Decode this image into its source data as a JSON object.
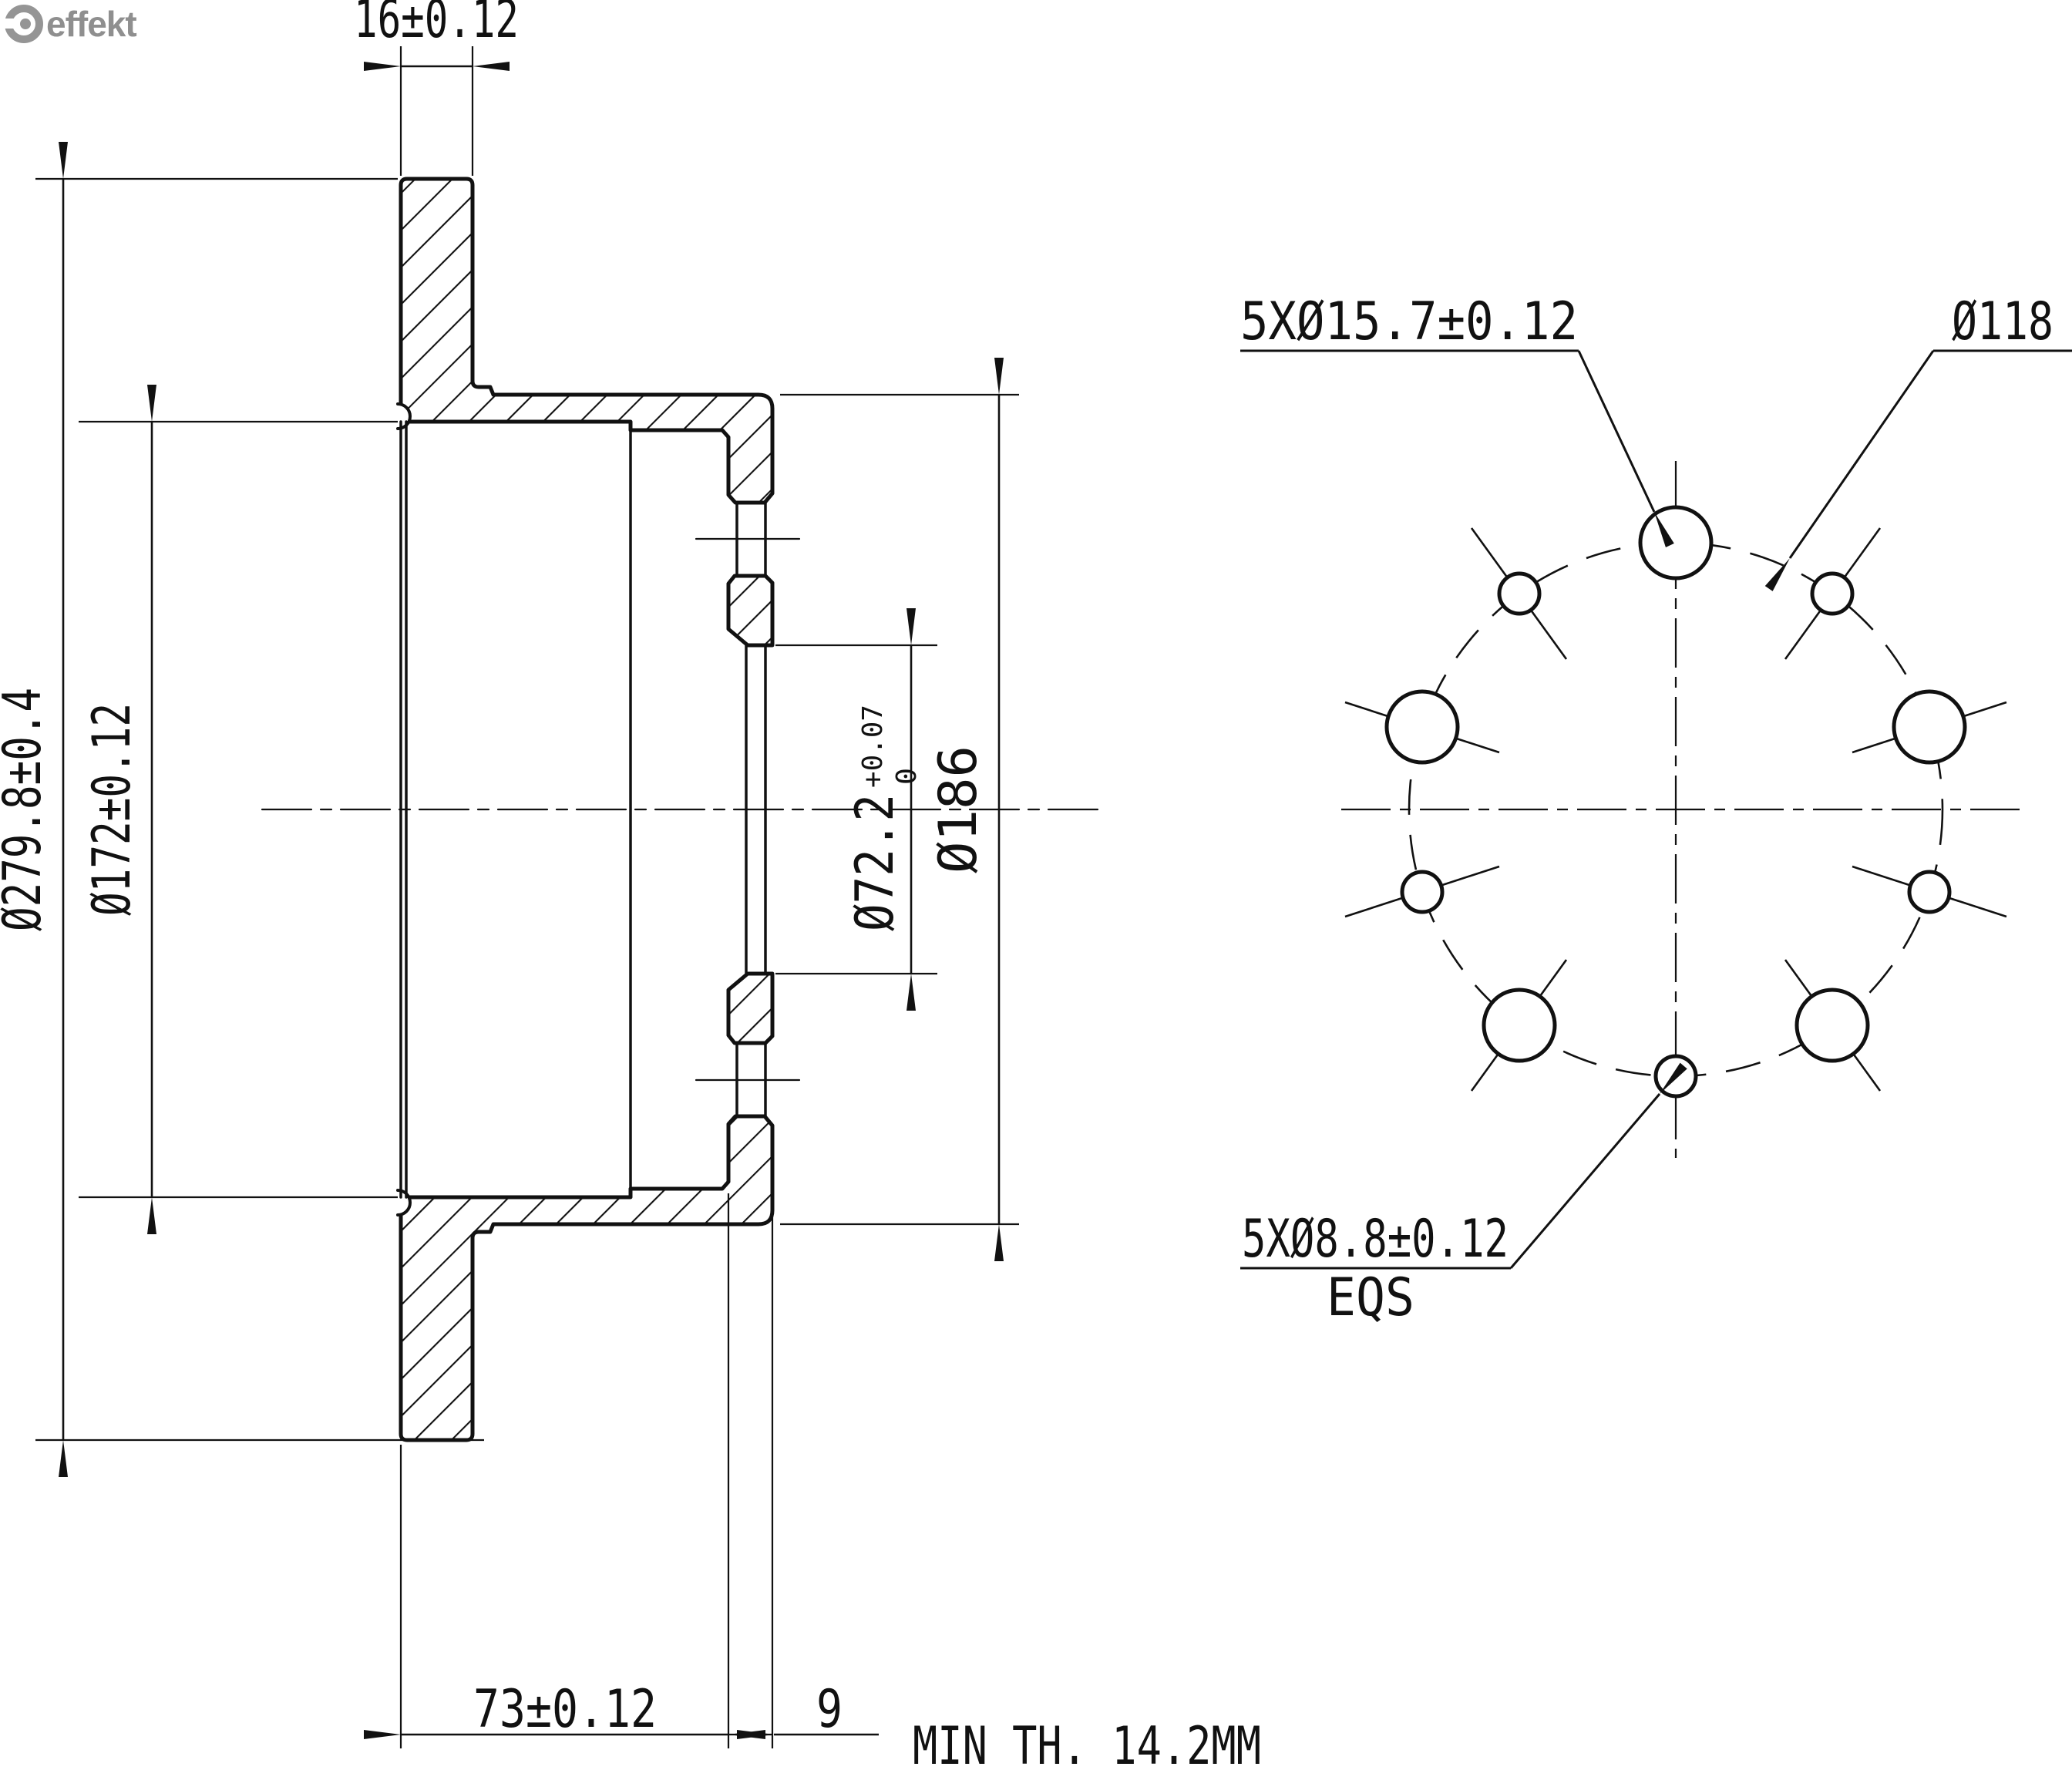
{
  "logo": {
    "brand": "effekt",
    "icon": "wrench-circle-icon"
  },
  "drawing": {
    "type": "technical-drawing",
    "part": "brake disc, section view and bolt-pattern view"
  },
  "dimensions": {
    "disc_thickness": "16±0.12",
    "outer_diameter": "Ø279.8±0.4",
    "friction_diameter": "Ø172±0.12",
    "bore_diameter": "Ø72.2",
    "bore_tol_plus": "+0.07",
    "bore_tol_zero": "0",
    "hat_diameter": "Ø186",
    "hat_depth": "73±0.12",
    "flange_thickness": "9"
  },
  "holes": {
    "large_pattern": "5XØ15.7±0.12",
    "bolt_circle": "Ø118",
    "small_pattern": "5XØ8.8±0.12",
    "equally_spaced": "EQS"
  },
  "notes": {
    "min_thickness": "MIN TH. 14.2MM"
  },
  "colors": {
    "line": "#111111",
    "logo_gray": "#8f8f8f",
    "background": "#ffffff"
  }
}
